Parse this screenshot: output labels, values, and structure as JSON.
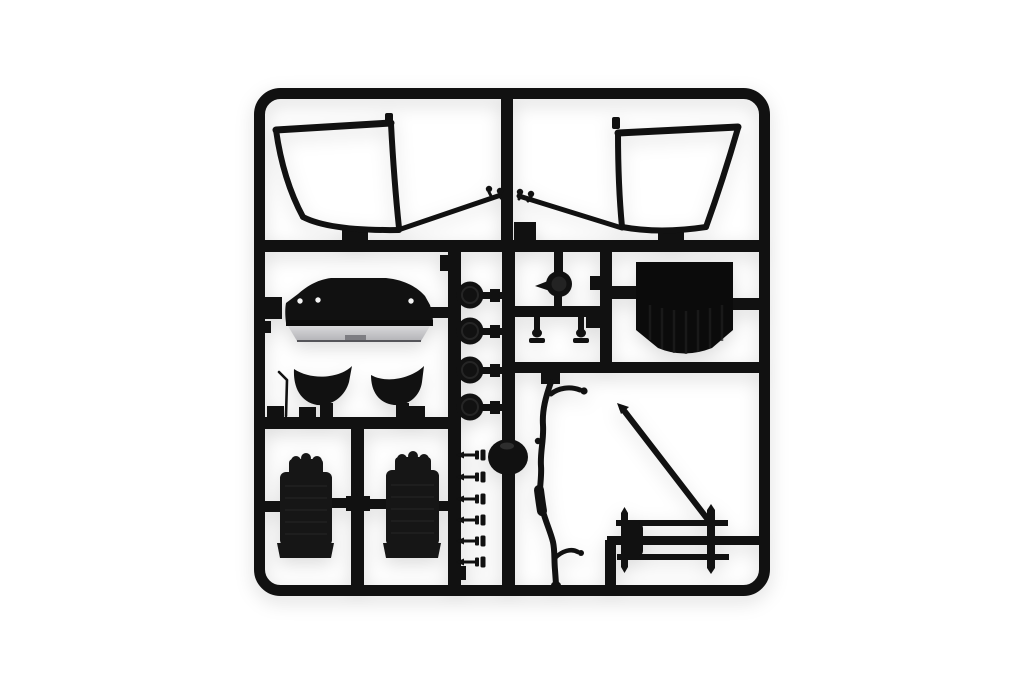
{
  "image": {
    "description": "Product photo of a black plastic scale-model kit sprue (injection-moulded parts tree) on a plain white background",
    "width_px": 1024,
    "height_px": 678
  },
  "colors": {
    "background": "#ffffff",
    "plastic": "#111111",
    "plastic_dark": "#0b0b0b",
    "plastic_soft": "#161616",
    "plastic_highlight": "#3a3a3a",
    "skirt_light": "#d8d8da",
    "skirt_shade": "#b3b3b7",
    "skirt_notch": "#7d7d82",
    "dot": "#f4f4f4",
    "ridge": "#262626",
    "shadow": "rgba(0,0,0,0.14)"
  },
  "parts": {
    "frame": {
      "label": "square sprue frame with internal runners"
    },
    "windshield_left": {
      "label": "windscreen frame part, left"
    },
    "windshield_right": {
      "label": "windscreen frame part, right"
    },
    "braces": {
      "label": "diagonal brace rods with pin knobs"
    },
    "cowl": {
      "label": "cowl bonnet panel with light grey lower skirt"
    },
    "fenders": {
      "label": "two curved shell parts with antenna rod"
    },
    "wheel_discs": {
      "label": "four round disc parts on center runner",
      "count": 4
    },
    "drum": {
      "label": "round drum part with pointer lever"
    },
    "hanger_pins": {
      "label": "two small mushroom hanger pins",
      "count": 2
    },
    "rear_panel": {
      "label": "large dark rear panel part"
    },
    "dome": {
      "label": "dome-shaped hub on center runner"
    },
    "pegs": {
      "label": "column of six small peg parts",
      "count": 6
    },
    "gear_lever": {
      "label": "lever blade part between seats"
    },
    "seat_left": {
      "label": "bucket seat part, left"
    },
    "seat_right": {
      "label": "bucket seat part, right"
    },
    "exhaust": {
      "label": "curved exhaust pipe part"
    },
    "support_rod": {
      "label": "diagonal support rod part"
    },
    "axle": {
      "label": "axle rods assembly part"
    }
  }
}
